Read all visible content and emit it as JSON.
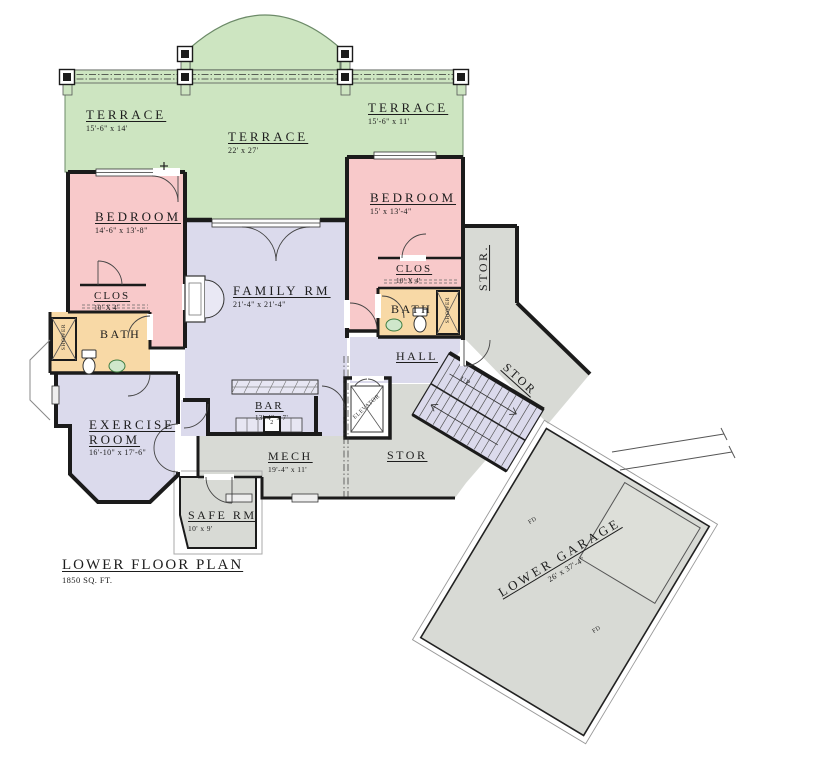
{
  "title": {
    "name": "LOWER FLOOR PLAN",
    "area": "1850 SQ. FT."
  },
  "rooms": {
    "terrace_left": {
      "name": "TERRACE",
      "dims": "15'-6\" x 14'"
    },
    "terrace_center": {
      "name": "TERRACE",
      "dims": "22' x 27'"
    },
    "terrace_right": {
      "name": "TERRACE",
      "dims": "15'-6\" x 11'"
    },
    "bedroom_left": {
      "name": "BEDROOM",
      "dims": "14'-6\" x 13'-8\""
    },
    "bedroom_right": {
      "name": "BEDROOM",
      "dims": "15' x 13'-4\""
    },
    "family_room": {
      "name": "FAMILY RM",
      "dims": "21'-4\" x 21'-4\""
    },
    "closet_left": {
      "name": "CLOS",
      "dims": "10' X 4'"
    },
    "closet_right": {
      "name": "CLOS",
      "dims": "10' X 4'"
    },
    "bath_left": {
      "name": "BATH"
    },
    "bath_right": {
      "name": "BATH"
    },
    "shower_left": {
      "name": "SHOWER"
    },
    "shower_right": {
      "name": "SHOWER"
    },
    "hall": {
      "name": "HALL"
    },
    "bar": {
      "name": "BAR",
      "dims": "13'-4\" x 7'"
    },
    "mech": {
      "name": "MECH",
      "dims": "19'-4\" x 11'"
    },
    "stor_upper": {
      "name": "STOR."
    },
    "stor_mid": {
      "name": "STOR"
    },
    "stor_diag": {
      "name": "STOR"
    },
    "exercise_room": {
      "name": "EXERCISE ROOM",
      "dims": "16'-10\" x 17'-6\""
    },
    "safe_room": {
      "name": "SAFE RM",
      "dims": "10' x 9'"
    },
    "elevator": {
      "name": "ELEVATOR"
    },
    "garage": {
      "name": "LOWER GARAGE",
      "dims": "26' x 37'-4\""
    }
  },
  "annotations": {
    "stairs_up": "UP",
    "floor_drain": "FD",
    "range_number": "2"
  },
  "colors": {
    "terrace": "#cde5c1",
    "bedroom": "#f8c9ca",
    "living": "#dbdaec",
    "bath": "#f8d9a6",
    "utility": "#d8dad5",
    "counter": "#e7e6f3",
    "garage_pad": "#dddfd9",
    "sink": "#cfe7cb",
    "wall": "#1b1b1b"
  }
}
